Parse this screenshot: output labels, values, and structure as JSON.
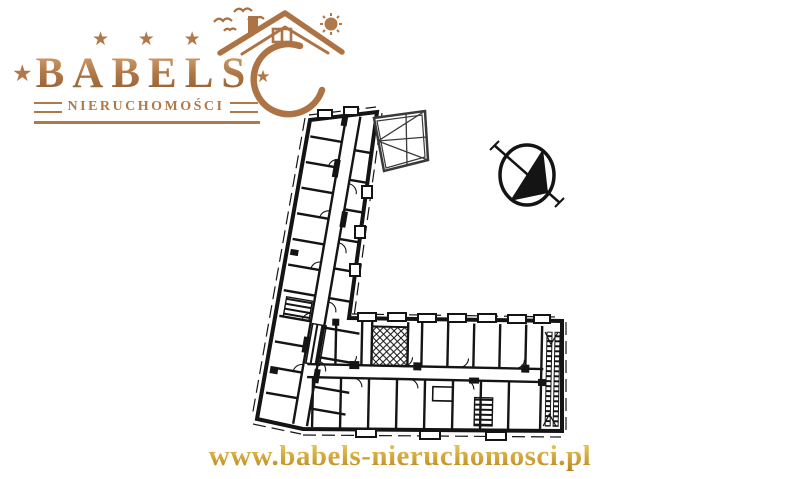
{
  "logo": {
    "stars_top": "★ ★ ★",
    "star_left": "★",
    "name": "BABELS",
    "star_right": "★",
    "subtitle": "NIERUCHOMOŚCI",
    "colors": {
      "copper": "#b1794a",
      "copper_dark": "#8f5c30"
    },
    "icons": {
      "house_roof": "roof-outline-with-chimney",
      "sun": "sun-disc-with-rays",
      "birds": "flying-birds-strokes",
      "crescent": "crescent-swoosh",
      "star": "★"
    }
  },
  "floor_plan": {
    "ink_color": "#141414",
    "compass_icon": "north-arrow-in-circle"
  },
  "footer": {
    "website": "www.babels-nieruchomosci.pl",
    "color_gold": "#cf9e2e"
  }
}
